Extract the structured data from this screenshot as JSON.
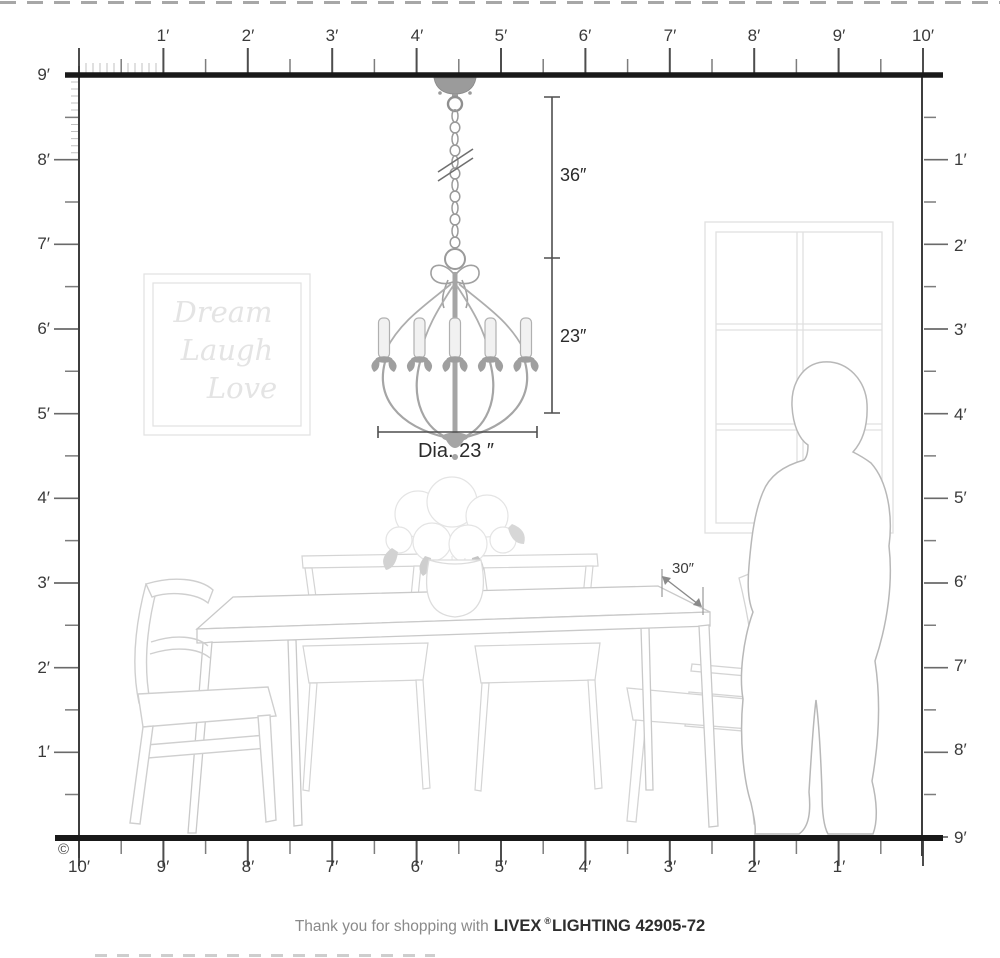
{
  "footer": {
    "prefix": "Thank you for shopping with",
    "brand": "LIVEX",
    "registered": "®",
    "suffix": "LIGHTING 42905-72"
  },
  "copyright": "©",
  "rulers": {
    "top": [
      "1′",
      "2′",
      "3′",
      "4′",
      "5′",
      "6′",
      "7′",
      "8′",
      "9′",
      "10′"
    ],
    "left": [
      "9′",
      "8′",
      "7′",
      "6′",
      "5′",
      "4′",
      "3′",
      "2′",
      "1′"
    ],
    "right": [
      "1′",
      "2′",
      "3′",
      "4′",
      "5′",
      "6′",
      "7′",
      "8′",
      "9′"
    ],
    "bottom": [
      "10′",
      "9′",
      "8′",
      "7′",
      "6′",
      "5′",
      "4′",
      "3′",
      "2′",
      "1′"
    ]
  },
  "dimensions": {
    "chain_length": "36″",
    "fixture_height": "23″",
    "fixture_diameter": "Dia. 23 ″",
    "table_depth": "30″"
  },
  "wall_art": {
    "line1": "Dream",
    "line2": "Laugh",
    "line3": "Love"
  },
  "colors": {
    "structure_line": "#1a1a1a",
    "ruler_text": "#3a3a3a",
    "dimension_line": "#4f4f4f",
    "fixture_gray": "#9b9b9b",
    "furniture_faint": "#d2d2d2",
    "art_faint": "#e4e4e4",
    "footer_gray": "#8a8a8a"
  }
}
